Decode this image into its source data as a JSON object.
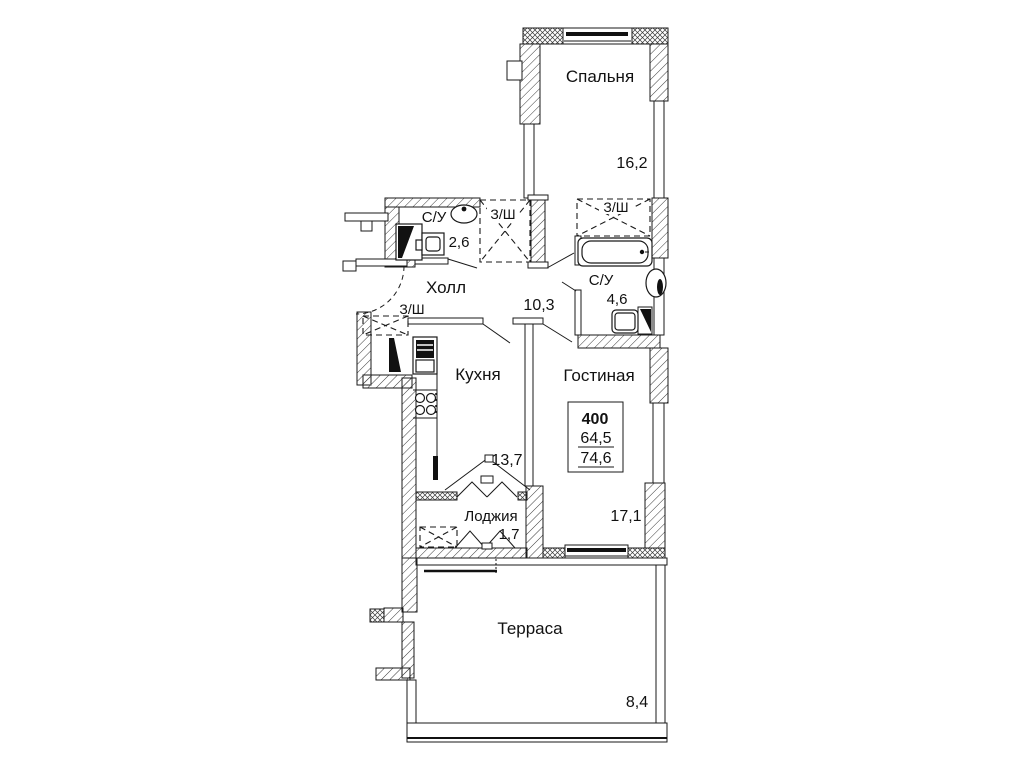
{
  "title": "Floor plan of apartment 400",
  "apartment": {
    "number": "400",
    "area_living": "64,5",
    "area_total": "74,6"
  },
  "rooms": {
    "bedroom": {
      "label": "Спальня",
      "area": "16,2"
    },
    "bathroom_small": {
      "label": "С/У",
      "area": "2,6"
    },
    "closet_top": {
      "label": "З/Ш"
    },
    "closet_bedroom": {
      "label": "З/Ш"
    },
    "bathroom_main": {
      "label": "С/У",
      "area": "4,6"
    },
    "hall": {
      "label": "Холл",
      "area": "10,3"
    },
    "closet_hall": {
      "label": "З/Ш"
    },
    "kitchen": {
      "label": "Кухня",
      "area": "13,7"
    },
    "living_room": {
      "label": "Гостиная",
      "area": "17,1"
    },
    "loggia": {
      "label": "Лоджия",
      "area": "1,7"
    },
    "terrace": {
      "label": "Терраса",
      "area": "8,4"
    }
  },
  "colors": {
    "line": "#1a1a1a",
    "background": "#ffffff"
  }
}
